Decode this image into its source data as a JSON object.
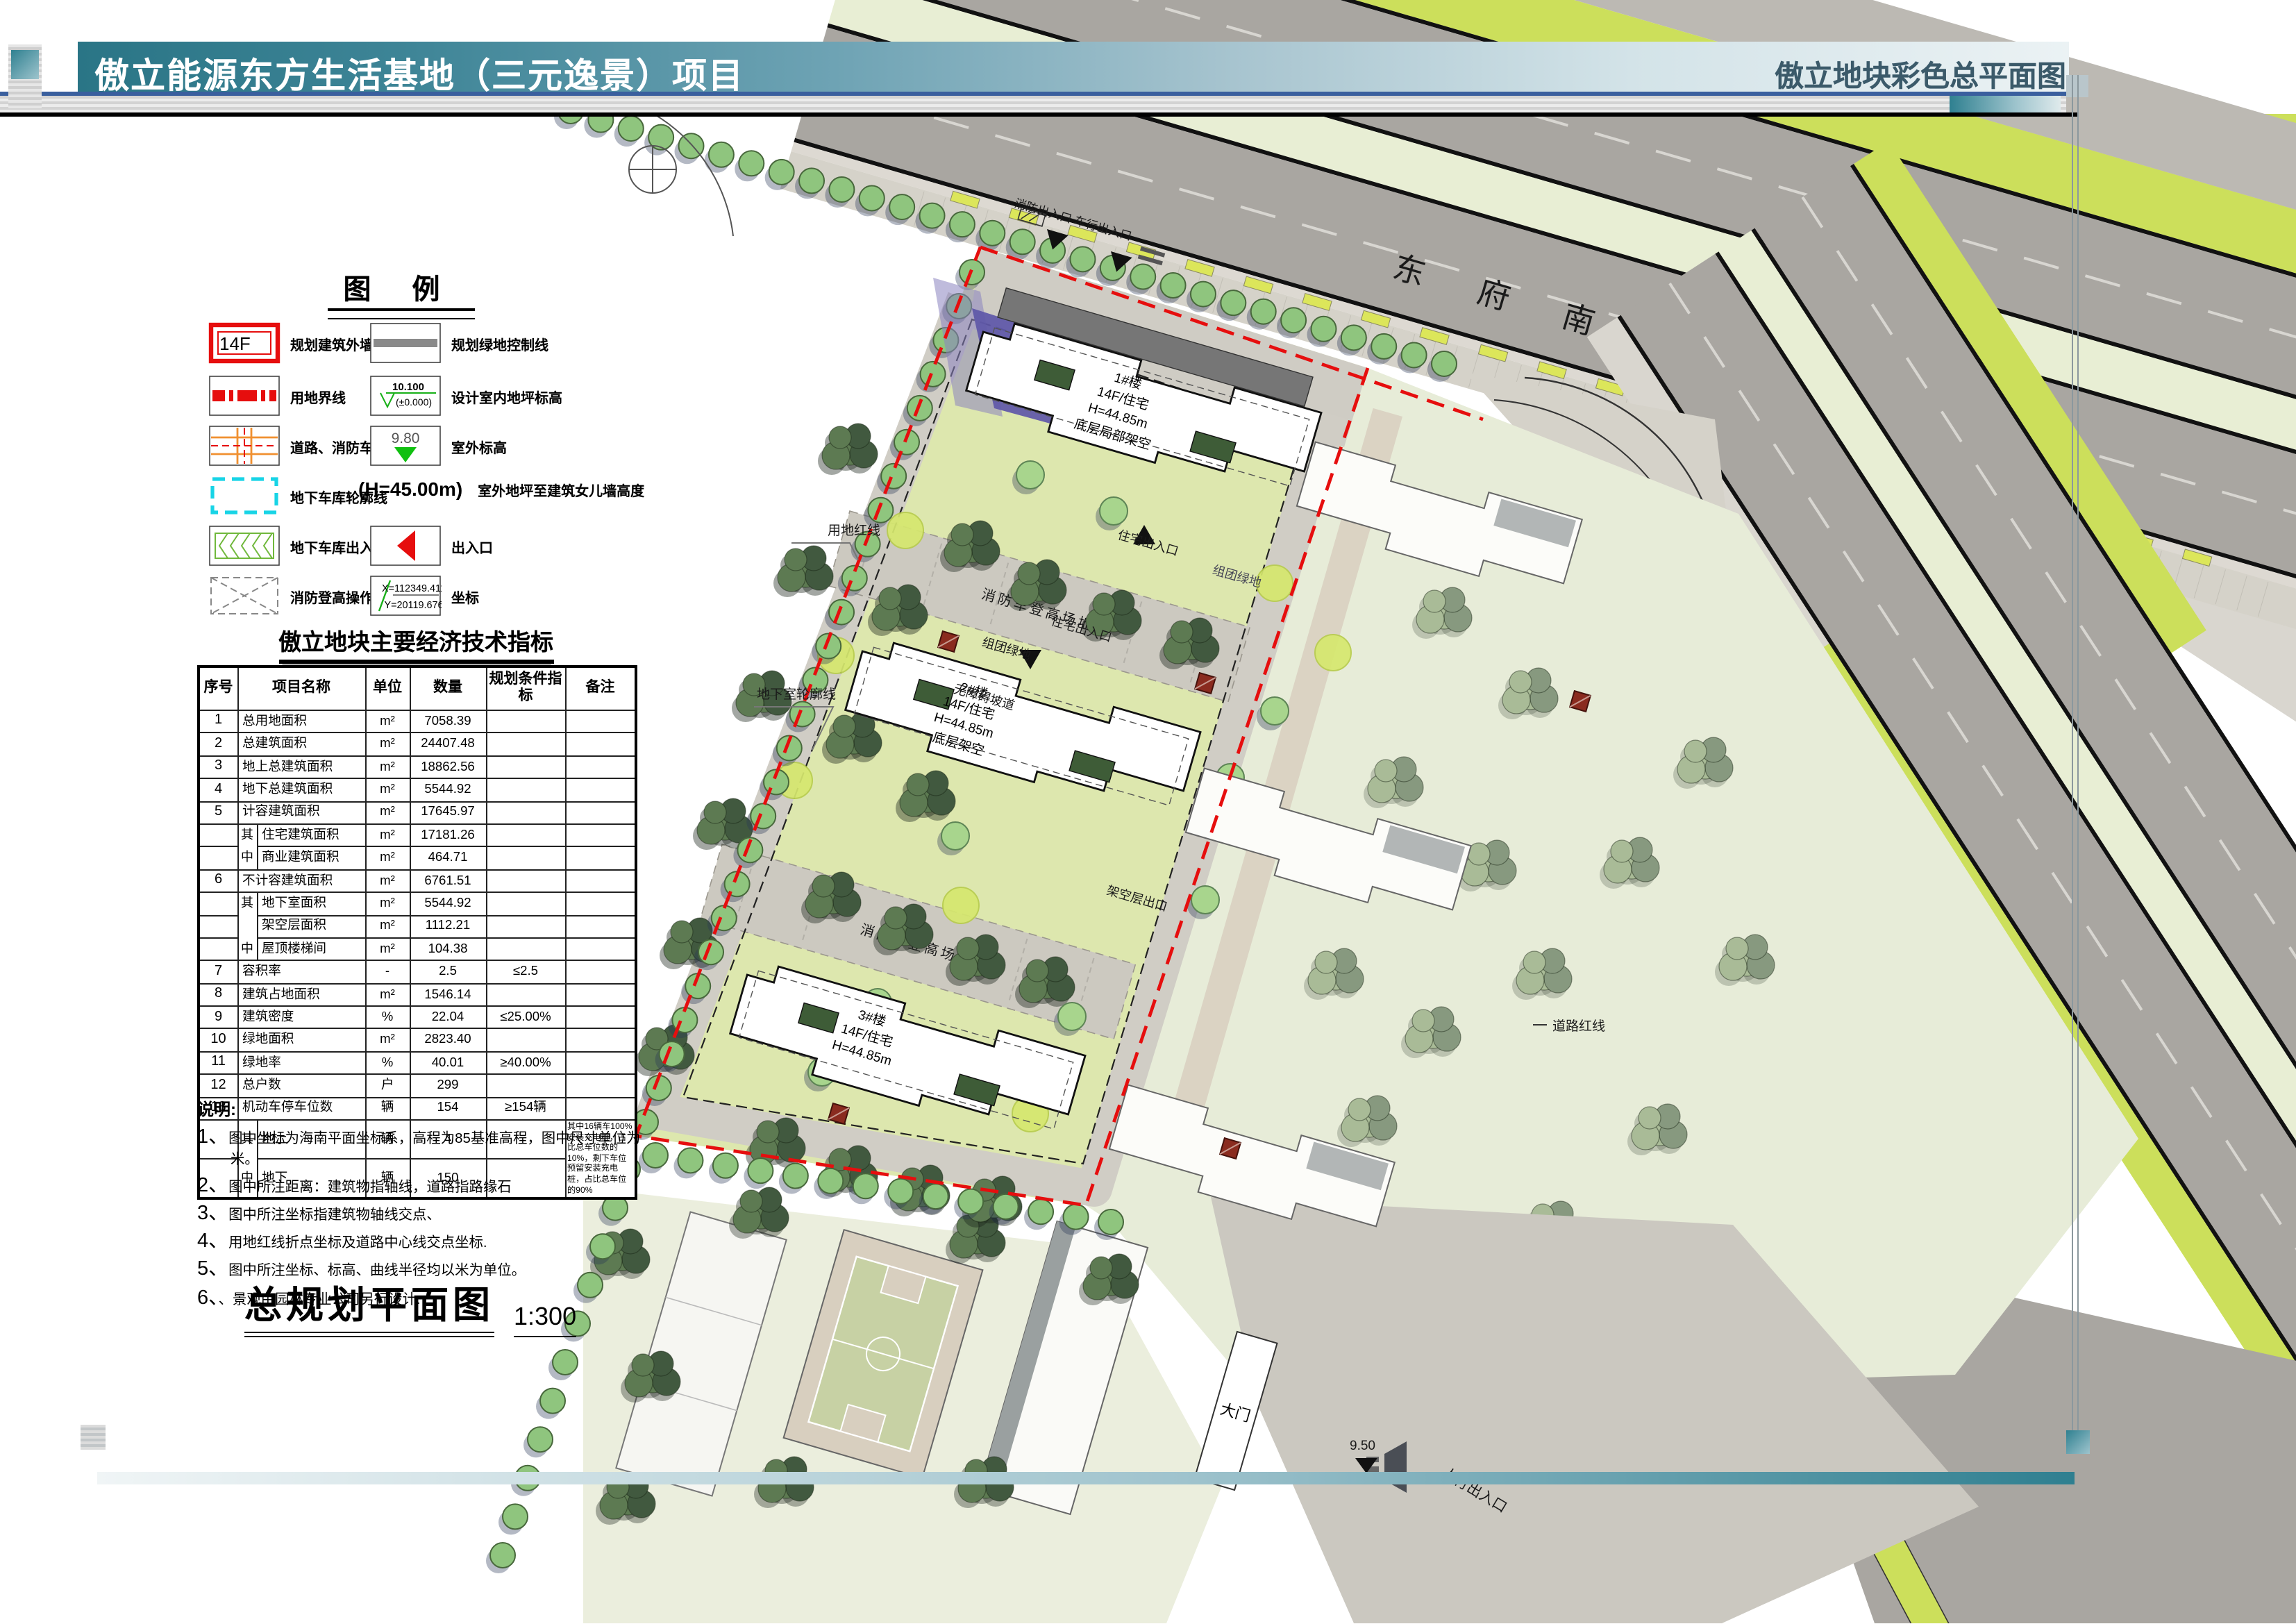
{
  "header": {
    "title_left": "傲立能源东方生活基地（三元逸景）项目",
    "title_right": "傲立地块彩色总平面图"
  },
  "legend": {
    "title": "图  例",
    "left": [
      {
        "sym": "14F",
        "label": "规划建筑外墙线及层数"
      },
      {
        "label": "用地界线"
      },
      {
        "label": "道路、消防车道"
      },
      {
        "label": "地下车库轮廓线"
      },
      {
        "label": "地下车库出入口"
      },
      {
        "label": "消防登高操作场地"
      }
    ],
    "right": [
      {
        "label": "规划绿地控制线"
      },
      {
        "v1": "10.100",
        "v2": "(±0.000)",
        "label": "设计室内地坪标高"
      },
      {
        "v": "9.80",
        "label": "室外标高"
      },
      {
        "v": "(H=45.00m)",
        "label": "室外地坪至建筑女儿墙高度"
      },
      {
        "label": "出入口"
      },
      {
        "x": "X=112349.411",
        "y": "Y=20119.676",
        "label": "坐标"
      }
    ]
  },
  "table": {
    "title": "傲立地块主要经济技术指标",
    "headers": [
      "序号",
      "项目名称",
      "单位",
      "数量",
      "规划条件指标",
      "备注"
    ],
    "rows": [
      {
        "no": "1",
        "name": "总用地面积",
        "unit": "m²",
        "qty": "7058.39"
      },
      {
        "no": "2",
        "name": "总建筑面积",
        "unit": "m²",
        "qty": "24407.48"
      },
      {
        "no": "3",
        "name": "地上总建筑面积",
        "unit": "m²",
        "qty": "18862.56"
      },
      {
        "no": "4",
        "name": "地下总建筑面积",
        "unit": "m²",
        "qty": "5544.92"
      },
      {
        "no": "5",
        "name": "计容建筑面积",
        "unit": "m²",
        "qty": "17645.97"
      },
      {
        "prefix": "其",
        "name": "住宅建筑面积",
        "unit": "m²",
        "qty": "17181.26"
      },
      {
        "prefix": "中",
        "name": "商业建筑面积",
        "unit": "m²",
        "qty": "464.71"
      },
      {
        "no": "6",
        "name": "不计容建筑面积",
        "unit": "m²",
        "qty": "6761.51"
      },
      {
        "prefix": "其",
        "name": "地下室面积",
        "unit": "m²",
        "qty": "5544.92"
      },
      {
        "prefix": "",
        "name": "架空层面积",
        "unit": "m²",
        "qty": "1112.21"
      },
      {
        "prefix": "中",
        "name": "屋顶楼梯间",
        "unit": "m²",
        "qty": "104.38"
      },
      {
        "no": "7",
        "name": "容积率",
        "unit": "-",
        "qty": "2.5",
        "cond": "≤2.5"
      },
      {
        "no": "8",
        "name": "建筑占地面积",
        "unit": "m²",
        "qty": "1546.14"
      },
      {
        "no": "9",
        "name": "建筑密度",
        "unit": "%",
        "qty": "22.04",
        "cond": "≤25.00%"
      },
      {
        "no": "10",
        "name": "绿地面积",
        "unit": "m²",
        "qty": "2823.40"
      },
      {
        "no": "11",
        "name": "绿地率",
        "unit": "%",
        "qty": "40.01",
        "cond": "≥40.00%"
      },
      {
        "no": "12",
        "name": "总户数",
        "unit": "户",
        "qty": "299"
      },
      {
        "no": "13",
        "name": "机动车停车位数",
        "unit": "辆",
        "qty": "154",
        "cond": "≥154辆"
      },
      {
        "prefix": "其",
        "name": "地上",
        "unit": "辆",
        "qty": "4",
        "remark": "其中16辆车100%安装充电桩，占比总车位数的10%，剩下车位预留安装充电桩，占比总车位的90%",
        "remark_rowspan": 2
      },
      {
        "prefix": "中",
        "name": "地下",
        "unit": "辆",
        "qty": "150",
        "remark_skip": true
      }
    ]
  },
  "notes": {
    "head": "说明:",
    "items": [
      "图中坐标为海南平面坐标系，高程为85基准高程，图中尺寸单位为米。",
      "图中所注距离：建筑物指轴线，道路指路缘石",
      "图中所注坐标指建筑物轴线交点、",
      "用地红线折点坐标及道路中心线交点坐标.",
      "图中所注坐标、标高、曲线半径均以米为单位。",
      "、景观由园林专业公司另行设计."
    ]
  },
  "plan": {
    "scale_title": "总规划平面图",
    "scale_value": "1:300",
    "road_name": "东 府 南 路",
    "labels": {
      "fire_entry": "消防出入口 车行出入口",
      "fire_field": "消防车登高场地",
      "res_entry": "住宅出入口",
      "barrier_free": "无障碍坡道",
      "stilt_exit": "架空层出口",
      "cluster_green": "组团绿地",
      "land_redline": "用地红线",
      "basement_outline": "地下室轮廓线",
      "road_redline": "道路红线",
      "gate": "大门",
      "ped_entry": "人行出入口",
      "elev_950": "9.50"
    },
    "buildings": [
      {
        "name": "1#楼",
        "type": "14F/住宅",
        "height": "H=44.85m",
        "note": "底层局部架空"
      },
      {
        "name": "2#楼",
        "type": "14F/住宅",
        "height": "H=44.85m",
        "note": "底层架空"
      },
      {
        "name": "3#楼",
        "type": "14F/住宅",
        "height": "H=44.85m",
        "note": "底层架空"
      }
    ]
  },
  "colors": {
    "accent_teal": "#2f7f90",
    "redline": "#e60e0e",
    "road_gray": "#a9a6a1",
    "verge_green": "#e8eed4",
    "lime": "#ccdf5b",
    "site_green": "#dde7ae"
  }
}
